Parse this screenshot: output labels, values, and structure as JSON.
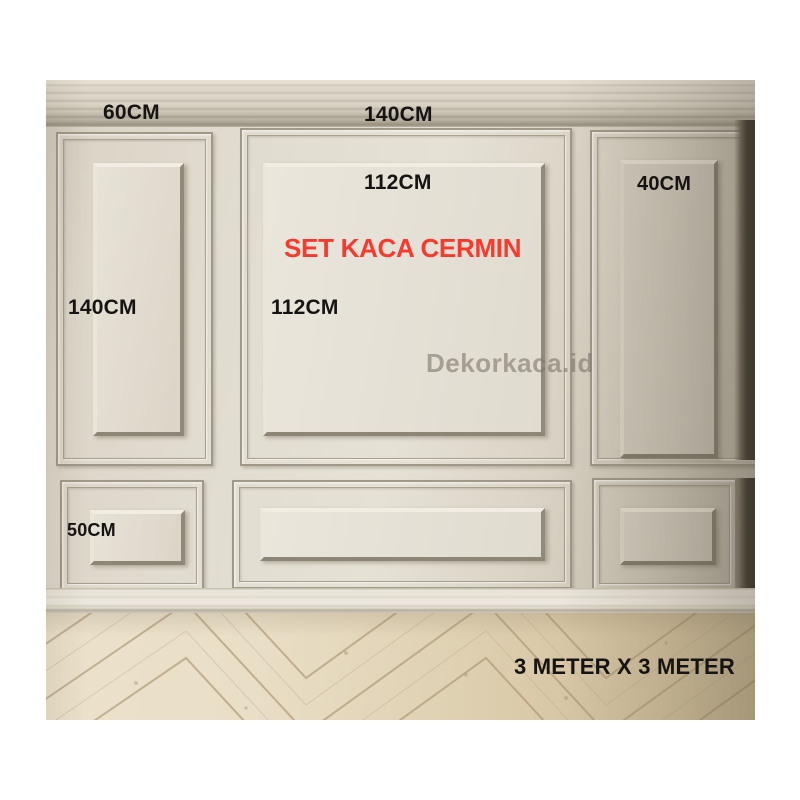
{
  "annotations": {
    "product_title": "SET KACA CERMIN",
    "watermark": "Dekorkaca.id",
    "room_size": "3 METER X 3 METER",
    "top_left_panel_width": "60CM",
    "top_center_panel_width": "140CM",
    "mirror_panel_width": "112CM",
    "mirror_panel_height": "112CM",
    "left_panel_height": "140CM",
    "right_panel_width": "40CM",
    "bottom_panel_height": "50CM"
  },
  "colors": {
    "title_red": "#f8392e",
    "label_black": "#161412",
    "watermark_gray": "#8a8174",
    "wall_beige": "#ddd7ca",
    "floor_tan": "#e2d4b6"
  }
}
